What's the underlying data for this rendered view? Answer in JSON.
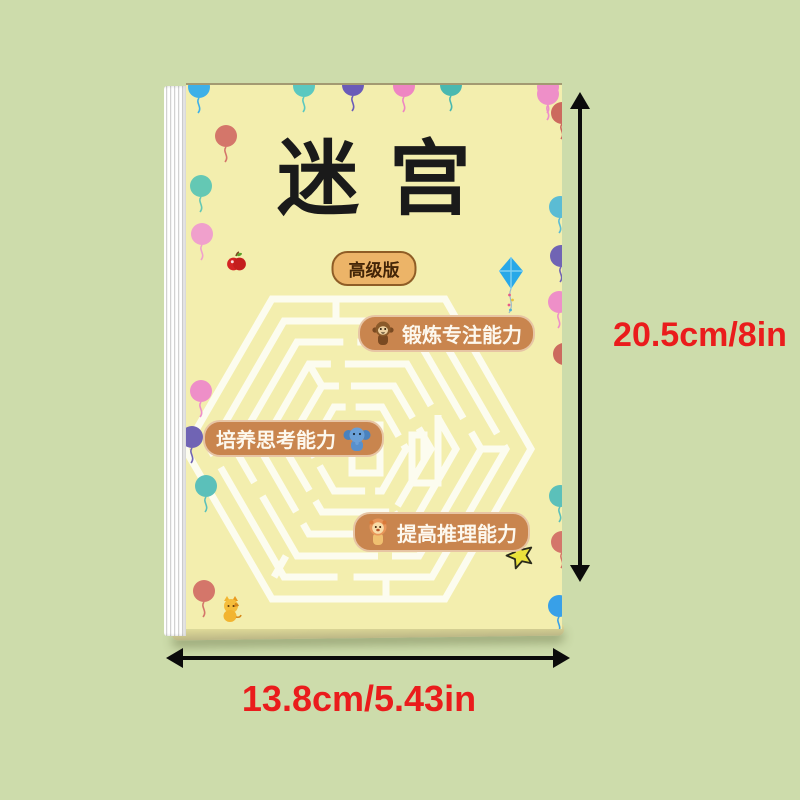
{
  "page": {
    "background_color": "#cddcab"
  },
  "book": {
    "cover_color": "#f3eeae",
    "title": "迷宫",
    "edition_badge": "高级版",
    "maze_graphic": "hexagonal-maze",
    "features": [
      {
        "icon": "monkey-icon",
        "label": "锻炼专注能力"
      },
      {
        "icon": "elephant-icon",
        "label": "培养思考能力"
      },
      {
        "icon": "lion-icon",
        "label": "提高推理能力"
      }
    ]
  },
  "dimensions": {
    "height_label": "20.5cm/8in",
    "width_label": "13.8cm/5.43in",
    "text_color": "#ea1c1c",
    "arrow_color": "#0b0b0b"
  },
  "decorations": {
    "feature_pill_color": "#c9854e",
    "badge_color": "#ecb468",
    "misc_icons": [
      "apple-icon",
      "kite-icon",
      "star-icon",
      "cat-icon"
    ],
    "balloons": [
      {
        "x": 1,
        "y": -9,
        "color": "#3db0e8"
      },
      {
        "x": 106,
        "y": -10,
        "color": "#5bc8c0"
      },
      {
        "x": 155,
        "y": -11,
        "color": "#6a5bb8"
      },
      {
        "x": 206,
        "y": -10,
        "color": "#ee85c2"
      },
      {
        "x": 253,
        "y": -11,
        "color": "#49b8b0"
      },
      {
        "x": 350,
        "y": -9,
        "color": "#ee8fc8"
      },
      {
        "x": 28,
        "y": 40,
        "color": "#d4766a"
      },
      {
        "x": 3,
        "y": 90,
        "color": "#64c8b4"
      },
      {
        "x": 4,
        "y": 138,
        "color": "#f0a0cc"
      },
      {
        "x": 3,
        "y": 295,
        "color": "#ee8fc8"
      },
      {
        "x": -6,
        "y": 341,
        "color": "#7064b4"
      },
      {
        "x": 8,
        "y": 390,
        "color": "#5bc0ba"
      },
      {
        "x": 6,
        "y": 495,
        "color": "#d4766a"
      },
      {
        "x": 350,
        "y": -2,
        "color": "#ee8fc8"
      },
      {
        "x": 364,
        "y": 17,
        "color": "#cc6a5e"
      },
      {
        "x": 362,
        "y": 111,
        "color": "#5bbcd4"
      },
      {
        "x": 363,
        "y": 160,
        "color": "#7064b4"
      },
      {
        "x": 361,
        "y": 206,
        "color": "#ee8fc8"
      },
      {
        "x": 366,
        "y": 258,
        "color": "#cc6a5e"
      },
      {
        "x": 362,
        "y": 400,
        "color": "#5bc0ba"
      },
      {
        "x": 364,
        "y": 446,
        "color": "#d4766a"
      },
      {
        "x": 361,
        "y": 510,
        "color": "#38a0e8"
      }
    ]
  }
}
